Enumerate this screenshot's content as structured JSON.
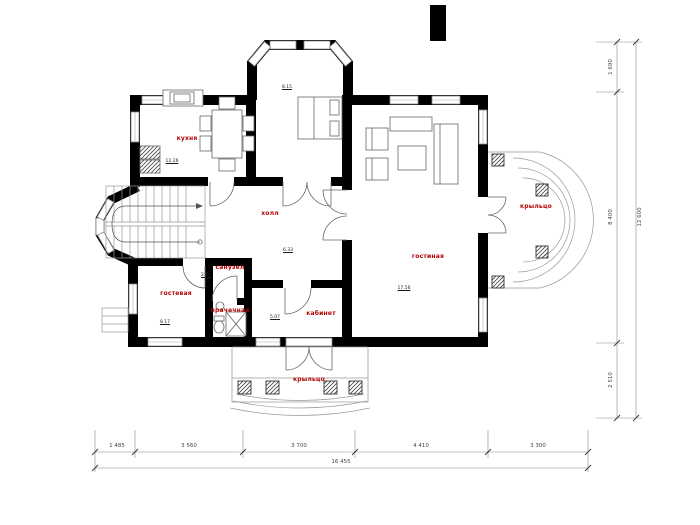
{
  "rooms": {
    "kitchen": {
      "label": "кухня",
      "area": "12.26"
    },
    "bedroom": {
      "area": "8.15"
    },
    "hall": {
      "label": "холл",
      "area": "6.33"
    },
    "living": {
      "label": "гостиная",
      "area": "17.56"
    },
    "guest": {
      "label": "гостевая",
      "area": "8.17"
    },
    "study": {
      "label": "кабинет",
      "area": "5.07"
    },
    "wc": {
      "label": "санузел",
      "area": "2.60"
    },
    "laundry": {
      "label": "прачечная"
    },
    "porch_right": {
      "label": "крыльцо"
    },
    "porch_bottom": {
      "label": "крыльцо"
    }
  },
  "dimensions": {
    "bottom": {
      "segments": [
        "1 485",
        "3 560",
        "3 700",
        "4 410",
        "3 300"
      ],
      "total": "16 455"
    },
    "right": {
      "segments": [
        "1 690",
        "8 400",
        "2 510"
      ],
      "total": "12 600"
    }
  },
  "colors": {
    "wall": "#000000",
    "room_label": "#b40000",
    "thin_line": "#777777"
  }
}
